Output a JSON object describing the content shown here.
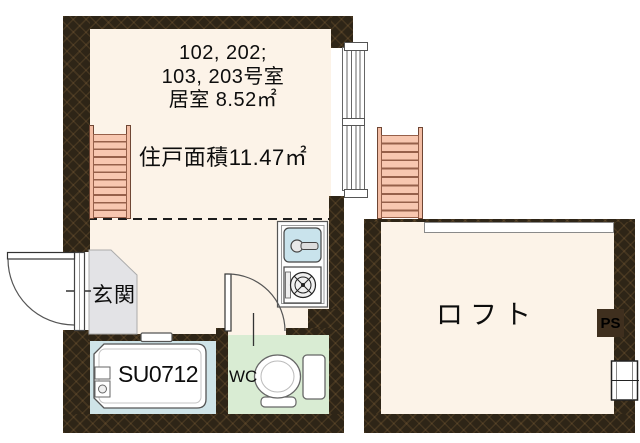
{
  "palette": {
    "wall": "#2e2517",
    "room_floor": "#fcf3e8",
    "entrance_floor": "#e3e3e6",
    "bath_floor": "#cfe4e8",
    "wc_floor": "#d9ecd3",
    "ladder": "#f8c7b0",
    "shoe_box": "#f3ee7e",
    "sink": "#c9e3ec",
    "line": "#444444",
    "text": "#0d0d0d"
  },
  "main_unit": {
    "room_numbers_line1": "102, 202;",
    "room_numbers_line2": "103, 203号室",
    "room_area": "居室 8.52㎡",
    "unit_area": "住戸面積11.47㎡",
    "entrance_label": "玄関",
    "shoe_box_label": "SB",
    "bath_unit_label": "SU0712",
    "toilet_label": "WC"
  },
  "loft": {
    "label": "ロフト",
    "pipe_space_label": "PS"
  }
}
